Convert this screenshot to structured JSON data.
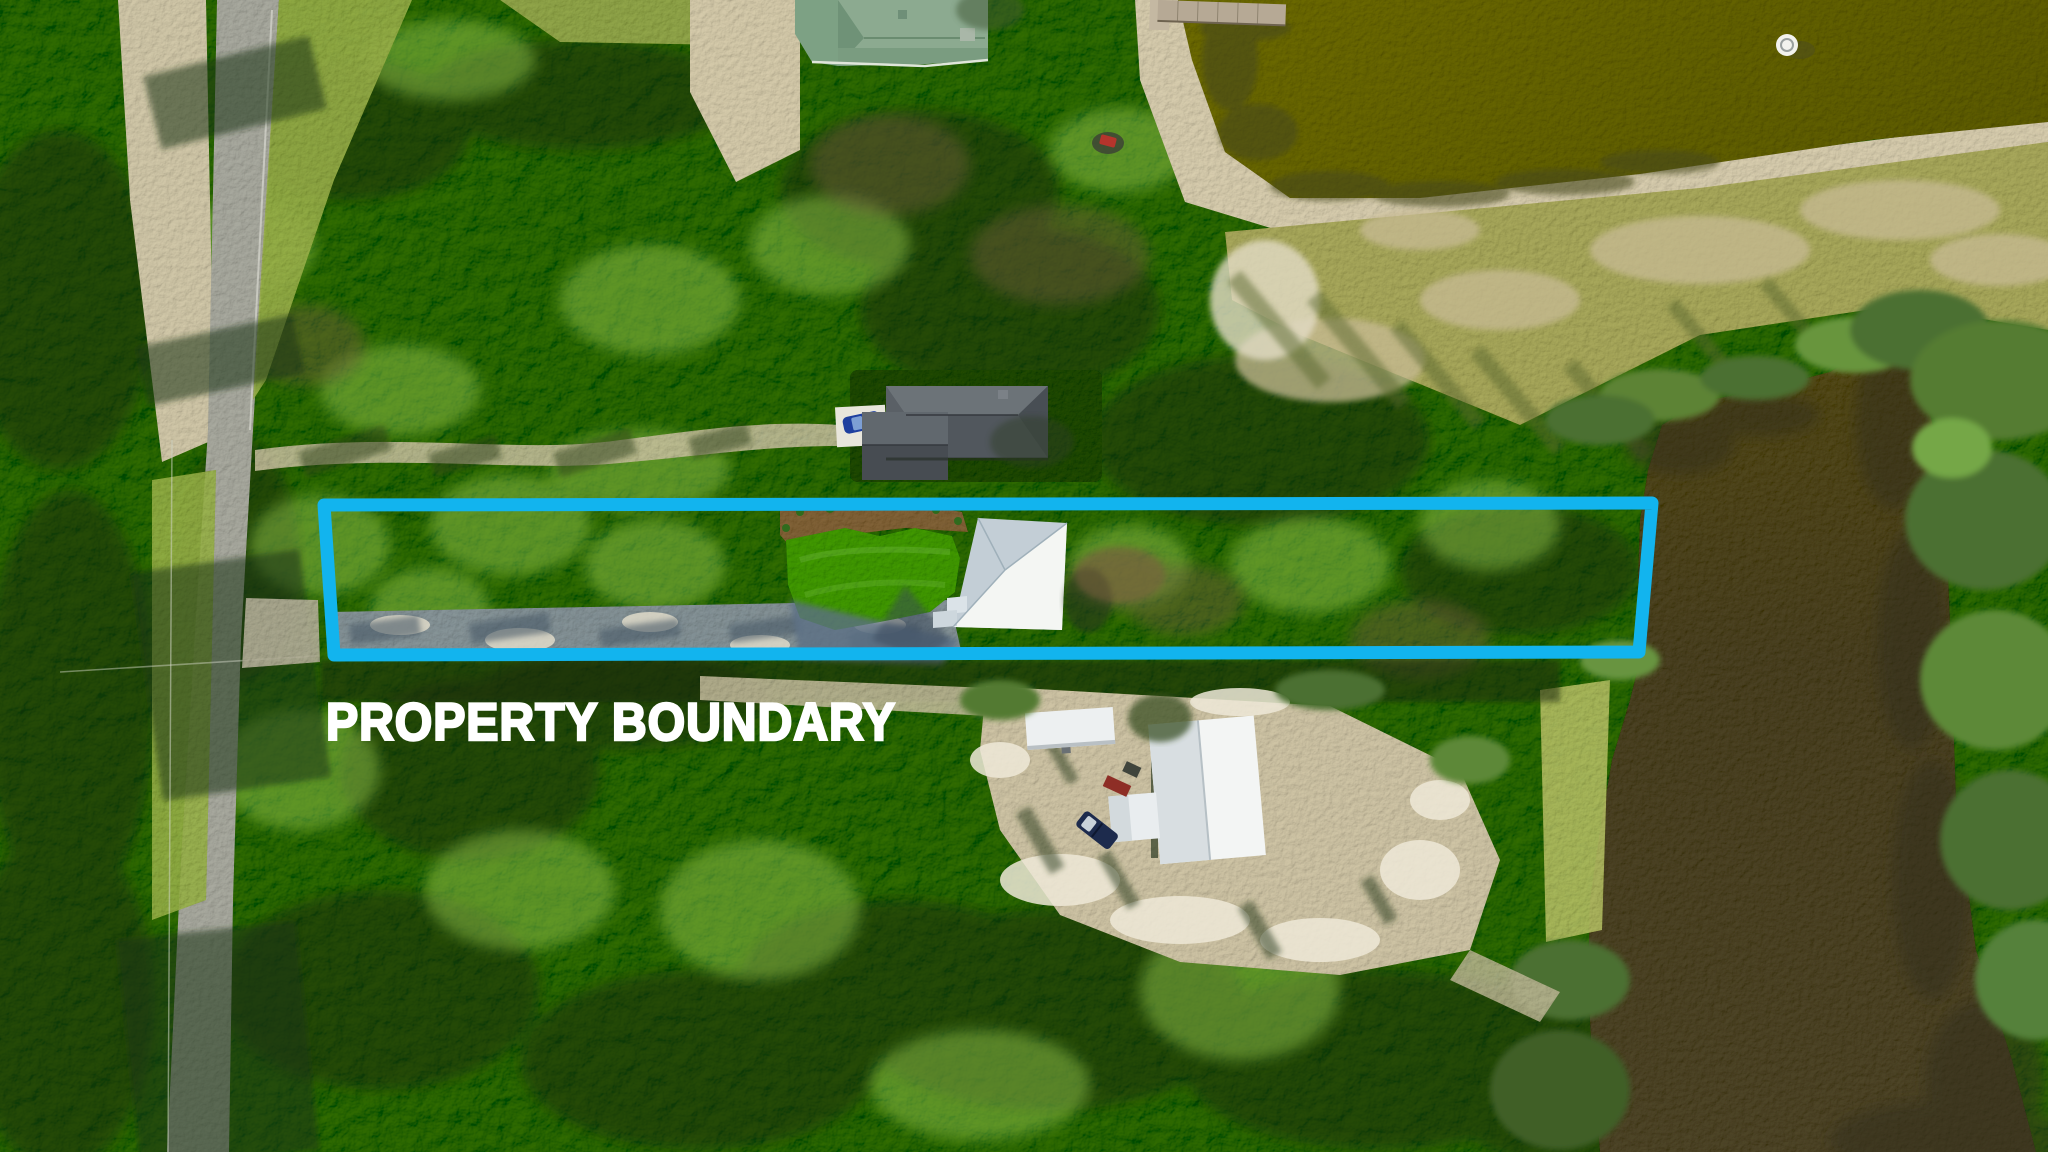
{
  "annotation": {
    "label": "PROPERTY BOUNDARY",
    "label_color": "#ffffff",
    "boundary_color": "#12b4ee"
  },
  "scene": {
    "type": "aerial-drone-photo",
    "features": [
      "forest-canopy",
      "paved-road",
      "dirt-driveway",
      "green-roof-house",
      "gray-roof-house",
      "white-roof-house",
      "white-barn",
      "storage-shed",
      "pickup-truck",
      "parked-car",
      "atv",
      "wooden-dock",
      "pond",
      "lake",
      "lawn",
      "sand-clearing",
      "grass-field",
      "buoy"
    ]
  },
  "palette": {
    "canopy": "#4e7430",
    "canopy_dark": "#203413",
    "canopy_light": "#8fc04c",
    "road": "#a9aaa0",
    "sand": "#cfc6a9",
    "pond_water": "#6f6d26",
    "lake_water": "#57503c",
    "field": "#a9a964",
    "lawn": "#4f9b2e"
  }
}
